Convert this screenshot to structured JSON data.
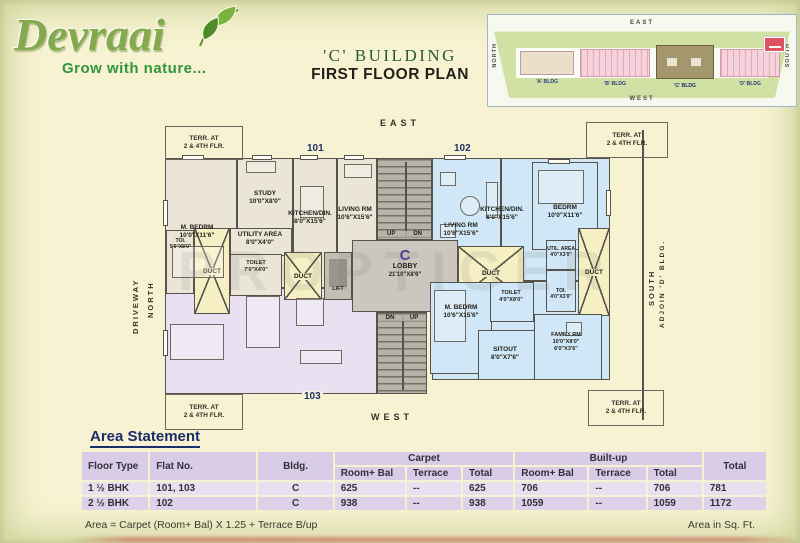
{
  "brand": {
    "name": "Devraai",
    "tagline": "Grow with nature..."
  },
  "title": {
    "building": "'C' BUILDING",
    "plan": "FIRST FLOOR PLAN"
  },
  "keyplan": {
    "east": "EAST",
    "west": "WEST",
    "north": "NORTH",
    "south": "SOUTH",
    "bldg_a": "'A' BLDG",
    "bldg_b": "'B' BLDG",
    "bldg_c": "'C' BLDG",
    "bldg_d": "'D' BLDG"
  },
  "compass": {
    "east": "EAST",
    "west": "WEST",
    "north": "NORTH",
    "driveway": "DRIVEWAY",
    "south": "SOUTH",
    "adjoin": "ADJOIN 'D' BLDG."
  },
  "flats": {
    "n101": "101",
    "n102": "102",
    "n103": "103"
  },
  "terrace": {
    "l1": "TERR. AT",
    "l2": "2 & 4TH FLR."
  },
  "core": {
    "duct": "DUCT",
    "lift": "LIFT",
    "up": "UP",
    "dn": "DN",
    "lobby_c": "C",
    "lobby": "LOBBY",
    "lobby_dim": "21'10\"X8'6\""
  },
  "watermark": "PROPTIGER",
  "rooms": {
    "u101": {
      "mbedrm": {
        "n": "M. BEDRM",
        "d": "10'0\"X11'6\""
      },
      "study": {
        "n": "STUDY",
        "d": "10'0\"X8'0\""
      },
      "kitchen": {
        "n": "KITCHEN/DIN.",
        "d": "8'0\"X15'6\""
      },
      "living": {
        "n": "LIVING RM",
        "d": "10'6\"X15'6\""
      },
      "utility": {
        "n": "UTILITY AREA",
        "d": "8'0\"X4'0\""
      },
      "toi": {
        "n": "TOI.",
        "d": "5'0\"X8'0\""
      },
      "toilet": {
        "n": "TOILET",
        "d": "7'0\"X4'0\""
      }
    },
    "u102": {
      "living": {
        "n": "LIVING RM",
        "d": "10'6\"X15'6\""
      },
      "kitchen": {
        "n": "KITCHEN/DIN.",
        "d": "8'0\"X15'6\""
      },
      "bedrm": {
        "n": "BEDRM",
        "d": "10'0\"X11'6\""
      },
      "mbedrm": {
        "n": "M. BEDRM",
        "d": "10'6\"X15'6\""
      },
      "toilet": {
        "n": "TOILET",
        "d": "4'0\"X8'0\""
      },
      "sitout": {
        "n": "SITOUT",
        "d": "8'0\"X7'6\""
      },
      "family": {
        "n": "FAMILY RM",
        "d": "10'0\"X8'0\"",
        "d2": "6'0\"X3'6\""
      },
      "util": {
        "n": "UTIL. AREA",
        "d": "4'0\"X3'0\""
      },
      "toi": {
        "n": "TOI.",
        "d": "4'0\"X3'0\""
      }
    }
  },
  "area_statement": {
    "title": "Area Statement",
    "headers": {
      "floor_type": "Floor Type",
      "flat_no": "Flat No.",
      "bldg": "Bldg.",
      "carpet": "Carpet",
      "builtup": "Built-up",
      "total": "Total",
      "room_bal": "Room+ Bal",
      "terrace": "Terrace",
      "sub_total": "Total"
    },
    "rows": [
      [
        "1 ½ BHK",
        "101, 103",
        "C",
        "625",
        "--",
        "625",
        "706",
        "--",
        "706",
        "781"
      ],
      [
        "2 ½ BHK",
        "102",
        "C",
        "938",
        "--",
        "938",
        "1059",
        "--",
        "1059",
        "1172"
      ]
    ],
    "formula": "Area = Carpet (Room+ Bal) X 1.25 + Terrace B/up",
    "unit_note": "Area in Sq. Ft."
  }
}
